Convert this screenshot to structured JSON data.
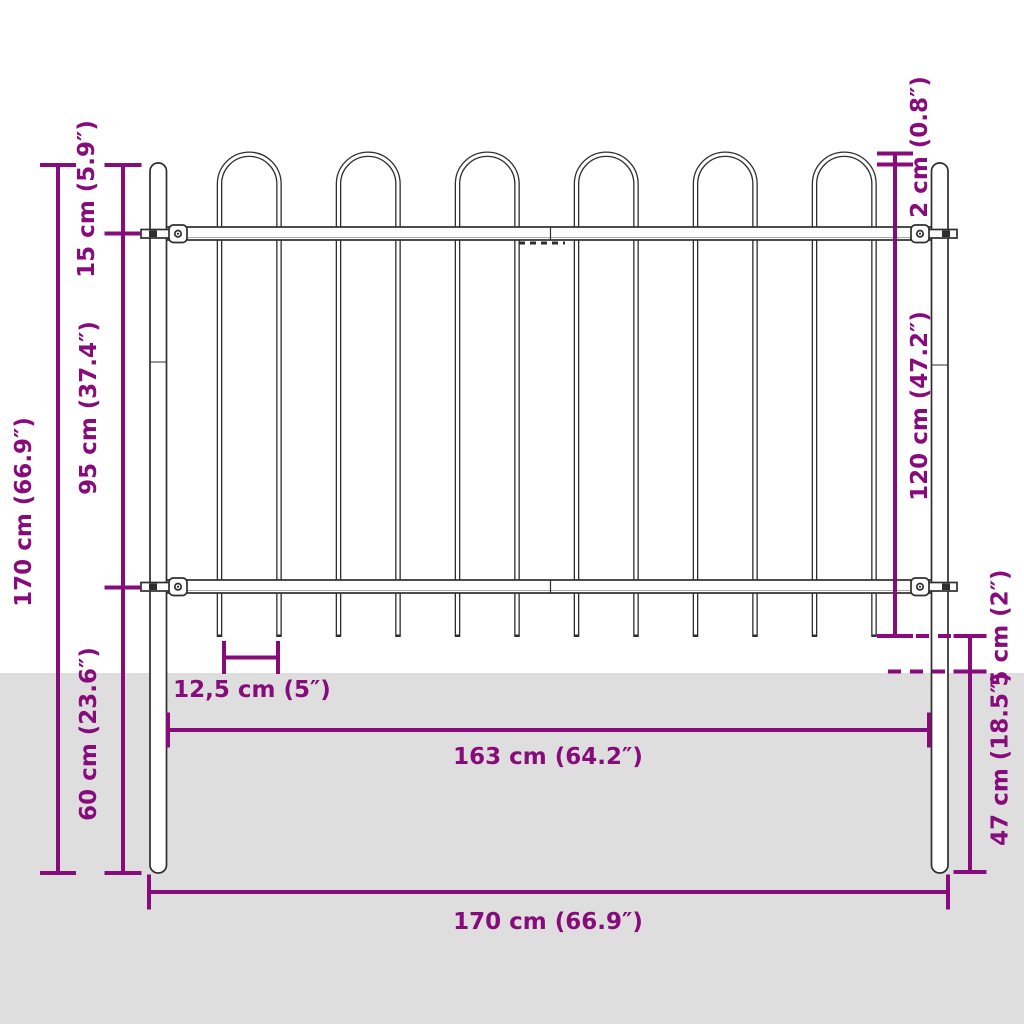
{
  "page": {
    "title": "Garden fence panel with hoop top – dimension diagram"
  },
  "colors": {
    "accent": "#880b7b",
    "outline": "#2e2e2e",
    "ground": "#dedede",
    "background": "#ffffff",
    "steel_fill": "#ffffff"
  },
  "diagram": {
    "subject": "steel garden fence panel with hoop-shaped bar tops, two round posts, partly set into the ground",
    "hoop_count": 6,
    "bar_count": 12,
    "post_count": 2,
    "rail_count": 2,
    "labels": {
      "height_total": "170 cm (66.9″)",
      "hoop_section": "15 cm (5.9″)",
      "rail_span": "95 cm (37.4″)",
      "below_rail": "60 cm (23.6″)",
      "hoop_over_post": "2 cm (0.8″)",
      "panel_height": "120 cm (47.2″)",
      "spike_to_ground": "5 cm (2″)",
      "post_in_ground": "47 cm (18.5″)",
      "bar_spacing": "12,5 cm (5″)",
      "width_inner": "163 cm (64.2″)",
      "width_total": "170 cm (66.9″)"
    }
  }
}
